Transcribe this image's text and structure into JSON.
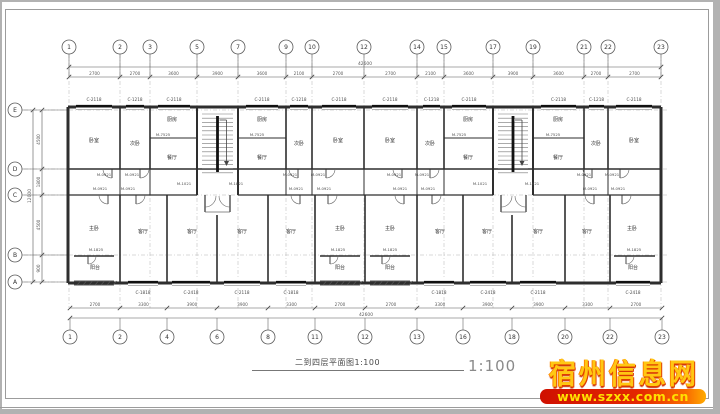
{
  "title_block": {
    "title": "二到四层平面图1:100",
    "scale": "1:100"
  },
  "watermark": {
    "site_name": "宿州信息网",
    "url": "www.szxx.com.cn",
    "banner_color": "#e42800",
    "url_color": "#ffe000",
    "name_color": "#ffc713"
  },
  "colors": {
    "wall": "#2e2e2e",
    "thin": "#6e6e6e",
    "grid": "#b5b5b5",
    "dim": "#5a5a5a",
    "bubble": "#5a5a5a",
    "room_text": "#333333",
    "tag_text": "#4a4a4a"
  },
  "grids": {
    "top": {
      "labels": [
        "1",
        "2",
        "3",
        "5",
        "7",
        "9",
        "10",
        "12",
        "14",
        "15",
        "17",
        "19",
        "21",
        "22",
        "23"
      ],
      "x": [
        69,
        120,
        150,
        197,
        238,
        286,
        312,
        364,
        417,
        444,
        493,
        533,
        584,
        608,
        661
      ],
      "bubble_y": 47
    },
    "bottom": {
      "labels": [
        "1",
        "2",
        "4",
        "6",
        "8",
        "11",
        "12",
        "13",
        "16",
        "18",
        "20",
        "22",
        "23"
      ],
      "x": [
        70,
        120,
        167,
        217,
        268,
        315,
        365,
        417,
        463,
        512,
        565,
        610,
        662
      ],
      "bubble_y": 337
    },
    "left": {
      "labels": [
        "E",
        "D",
        "C",
        "B",
        "A"
      ],
      "y": [
        110,
        169,
        195,
        255,
        282
      ],
      "bubble_x": 15
    }
  },
  "dimensions": {
    "top_values": [
      "2700",
      "2700",
      "3600",
      "3900",
      "3600",
      "2100",
      "2700",
      "2700",
      "2100",
      "3600",
      "3900",
      "3600",
      "2700",
      "2700"
    ],
    "top_total": "42600",
    "bottom_values": [
      "2700",
      "3300",
      "3900",
      "3900",
      "3300",
      "2700",
      "2700",
      "3300",
      "3900",
      "3900",
      "3300",
      "2700"
    ],
    "bottom_total": "42600",
    "left_values": [
      "4500",
      "1800",
      "4500",
      "900"
    ],
    "left_total": "12000"
  },
  "plan": {
    "outline": {
      "x1": 68,
      "y1": 107,
      "x2": 661,
      "y2": 283
    },
    "walls": [
      [
        68,
        107,
        661,
        107,
        3
      ],
      [
        68,
        283,
        661,
        283,
        3
      ],
      [
        68,
        107,
        68,
        283,
        3
      ],
      [
        661,
        107,
        661,
        283,
        3
      ],
      [
        68,
        169,
        661,
        169,
        1.5
      ],
      [
        68,
        195,
        197,
        195,
        1.3
      ],
      [
        238,
        195,
        493,
        195,
        1.3
      ],
      [
        533,
        195,
        661,
        195,
        1.3
      ],
      [
        74,
        256,
        114,
        256,
        1.6
      ],
      [
        320,
        256,
        360,
        256,
        1.6
      ],
      [
        370,
        256,
        410,
        256,
        1.6
      ],
      [
        614,
        256,
        655,
        256,
        1.6
      ],
      [
        120,
        107,
        120,
        169,
        1.6
      ],
      [
        150,
        107,
        150,
        169,
        1.6
      ],
      [
        197,
        107,
        197,
        195,
        2
      ],
      [
        238,
        107,
        238,
        195,
        2
      ],
      [
        286,
        107,
        286,
        169,
        1.6
      ],
      [
        312,
        107,
        312,
        169,
        1.6
      ],
      [
        364,
        107,
        364,
        169,
        1.6
      ],
      [
        417,
        107,
        417,
        169,
        1.6
      ],
      [
        444,
        107,
        444,
        169,
        1.6
      ],
      [
        493,
        107,
        493,
        195,
        2
      ],
      [
        533,
        107,
        533,
        195,
        2
      ],
      [
        584,
        107,
        584,
        169,
        1.6
      ],
      [
        608,
        107,
        608,
        169,
        1.6
      ],
      [
        120,
        169,
        120,
        195,
        1
      ],
      [
        150,
        169,
        150,
        195,
        1
      ],
      [
        286,
        169,
        286,
        195,
        1
      ],
      [
        312,
        169,
        312,
        195,
        1
      ],
      [
        364,
        169,
        364,
        195,
        1
      ],
      [
        417,
        169,
        417,
        195,
        1
      ],
      [
        444,
        169,
        444,
        195,
        1
      ],
      [
        584,
        169,
        584,
        195,
        1
      ],
      [
        608,
        169,
        608,
        195,
        1
      ],
      [
        120,
        195,
        120,
        283,
        1.6
      ],
      [
        167,
        195,
        167,
        283,
        1.6
      ],
      [
        217,
        215,
        217,
        283,
        1.6
      ],
      [
        268,
        195,
        268,
        283,
        1.6
      ],
      [
        315,
        195,
        315,
        283,
        1.6
      ],
      [
        365,
        195,
        365,
        283,
        1.6
      ],
      [
        417,
        195,
        417,
        283,
        1.6
      ],
      [
        463,
        195,
        463,
        283,
        1.6
      ],
      [
        512,
        215,
        512,
        283,
        1.6
      ],
      [
        565,
        195,
        565,
        283,
        1.6
      ],
      [
        610,
        195,
        610,
        283,
        1.6
      ],
      [
        150,
        138,
        197,
        138,
        0.9
      ],
      [
        238,
        138,
        286,
        138,
        0.9
      ],
      [
        444,
        138,
        493,
        138,
        0.9
      ],
      [
        533,
        138,
        584,
        138,
        0.9
      ]
    ],
    "stairs": [
      {
        "x1": 197,
        "x2": 238,
        "y1": 110,
        "y2": 176
      },
      {
        "x1": 493,
        "x2": 533,
        "y1": 110,
        "y2": 176
      }
    ],
    "entries": [
      {
        "x1": 205,
        "x2": 230,
        "y": 195,
        "depth": 17
      },
      {
        "x1": 501,
        "x2": 526,
        "y": 195,
        "depth": 17
      }
    ],
    "windows_top": [
      {
        "label": "C-2118",
        "x1": 76,
        "x2": 112
      },
      {
        "label": "C-1218",
        "x1": 126,
        "x2": 144
      },
      {
        "label": "C-2118",
        "x1": 158,
        "x2": 190
      },
      {
        "label": "C-2118",
        "x1": 246,
        "x2": 278
      },
      {
        "label": "C-1218",
        "x1": 290,
        "x2": 308
      },
      {
        "label": "C-2118",
        "x1": 322,
        "x2": 356
      },
      {
        "label": "C-2118",
        "x1": 372,
        "x2": 408
      },
      {
        "label": "C-1218",
        "x1": 423,
        "x2": 440
      },
      {
        "label": "C-2118",
        "x1": 452,
        "x2": 486
      },
      {
        "label": "C-2118",
        "x1": 541,
        "x2": 576
      },
      {
        "label": "C-1218",
        "x1": 589,
        "x2": 604
      },
      {
        "label": "C-2118",
        "x1": 616,
        "x2": 652
      }
    ],
    "windows_bottom": [
      {
        "label": "C-1818",
        "x1": 128,
        "x2": 158
      },
      {
        "label": "C-2418",
        "x1": 172,
        "x2": 210
      },
      {
        "label": "C-2118",
        "x1": 224,
        "x2": 260
      },
      {
        "label": "C-1818",
        "x1": 276,
        "x2": 306
      },
      {
        "label": "C-1818",
        "x1": 424,
        "x2": 454
      },
      {
        "label": "C-2418",
        "x1": 470,
        "x2": 506
      },
      {
        "label": "C-2118",
        "x1": 520,
        "x2": 556
      },
      {
        "label": "C-2418",
        "x1": 616,
        "x2": 650
      }
    ],
    "balconies": [
      {
        "x1": 74,
        "x2": 114
      },
      {
        "x1": 320,
        "x2": 360
      },
      {
        "x1": 370,
        "x2": 410
      }
    ],
    "doors": [
      {
        "x": 112,
        "y": 169,
        "r": 9,
        "o": "dl"
      },
      {
        "x": 140,
        "y": 169,
        "r": 9,
        "o": "dr"
      },
      {
        "x": 298,
        "y": 169,
        "r": 9,
        "o": "dl"
      },
      {
        "x": 326,
        "y": 169,
        "r": 9,
        "o": "dr"
      },
      {
        "x": 402,
        "y": 169,
        "r": 9,
        "o": "dl"
      },
      {
        "x": 430,
        "y": 169,
        "r": 9,
        "o": "dr"
      },
      {
        "x": 592,
        "y": 169,
        "r": 9,
        "o": "dl"
      },
      {
        "x": 620,
        "y": 169,
        "r": 9,
        "o": "dr"
      },
      {
        "x": 108,
        "y": 195,
        "r": 9,
        "o": "dl"
      },
      {
        "x": 136,
        "y": 195,
        "r": 9,
        "o": "dr"
      },
      {
        "x": 300,
        "y": 195,
        "r": 9,
        "o": "dl"
      },
      {
        "x": 328,
        "y": 195,
        "r": 9,
        "o": "dr"
      },
      {
        "x": 404,
        "y": 195,
        "r": 9,
        "o": "dl"
      },
      {
        "x": 432,
        "y": 195,
        "r": 9,
        "o": "dr"
      },
      {
        "x": 594,
        "y": 195,
        "r": 9,
        "o": "dl"
      },
      {
        "x": 622,
        "y": 195,
        "r": 9,
        "o": "dr"
      },
      {
        "x": 205,
        "y": 196,
        "r": 11,
        "o": "dr"
      },
      {
        "x": 230,
        "y": 196,
        "r": 11,
        "o": "dl"
      },
      {
        "x": 501,
        "y": 196,
        "r": 11,
        "o": "dr"
      },
      {
        "x": 526,
        "y": 196,
        "r": 11,
        "o": "dl"
      },
      {
        "x": 88,
        "y": 256,
        "r": 8,
        "o": "dr"
      },
      {
        "x": 330,
        "y": 256,
        "r": 8,
        "o": "dr"
      },
      {
        "x": 382,
        "y": 256,
        "r": 8,
        "o": "dr"
      },
      {
        "x": 626,
        "y": 256,
        "r": 8,
        "o": "dr"
      }
    ],
    "rooms": [
      {
        "label": "卧室",
        "x": 94,
        "y": 142
      },
      {
        "label": "卧室",
        "x": 338,
        "y": 142
      },
      {
        "label": "卧室",
        "x": 390,
        "y": 142
      },
      {
        "label": "卧室",
        "x": 634,
        "y": 142
      },
      {
        "label": "次卧",
        "x": 135,
        "y": 145
      },
      {
        "label": "次卧",
        "x": 299,
        "y": 145
      },
      {
        "label": "次卧",
        "x": 430,
        "y": 145
      },
      {
        "label": "次卧",
        "x": 596,
        "y": 145
      },
      {
        "label": "厨房",
        "x": 172,
        "y": 121
      },
      {
        "label": "厨房",
        "x": 262,
        "y": 121
      },
      {
        "label": "厨房",
        "x": 468,
        "y": 121
      },
      {
        "label": "厨房",
        "x": 558,
        "y": 121
      },
      {
        "label": "餐厅",
        "x": 172,
        "y": 159
      },
      {
        "label": "餐厅",
        "x": 262,
        "y": 159
      },
      {
        "label": "餐厅",
        "x": 468,
        "y": 159
      },
      {
        "label": "餐厅",
        "x": 558,
        "y": 159
      },
      {
        "label": "客厅",
        "x": 143,
        "y": 233
      },
      {
        "label": "客厅",
        "x": 192,
        "y": 233
      },
      {
        "label": "客厅",
        "x": 242,
        "y": 233
      },
      {
        "label": "客厅",
        "x": 291,
        "y": 233
      },
      {
        "label": "客厅",
        "x": 440,
        "y": 233
      },
      {
        "label": "客厅",
        "x": 487,
        "y": 233
      },
      {
        "label": "客厅",
        "x": 538,
        "y": 233
      },
      {
        "label": "客厅",
        "x": 587,
        "y": 233
      },
      {
        "label": "主卧",
        "x": 94,
        "y": 230
      },
      {
        "label": "主卧",
        "x": 340,
        "y": 230
      },
      {
        "label": "主卧",
        "x": 390,
        "y": 230
      },
      {
        "label": "主卧",
        "x": 632,
        "y": 230
      },
      {
        "label": "阳台",
        "x": 95,
        "y": 269
      },
      {
        "label": "阳台",
        "x": 340,
        "y": 269
      },
      {
        "label": "阳台",
        "x": 390,
        "y": 269
      },
      {
        "label": "阳台",
        "x": 633,
        "y": 269
      }
    ],
    "door_tags": [
      {
        "text": "M-0921",
        "x": 104,
        "y": 176
      },
      {
        "text": "M-0921",
        "x": 132,
        "y": 176
      },
      {
        "text": "M-0921",
        "x": 290,
        "y": 176
      },
      {
        "text": "M-0921",
        "x": 318,
        "y": 176
      },
      {
        "text": "M-0921",
        "x": 394,
        "y": 176
      },
      {
        "text": "M-0921",
        "x": 422,
        "y": 176
      },
      {
        "text": "M-0921",
        "x": 584,
        "y": 176
      },
      {
        "text": "M-0921",
        "x": 612,
        "y": 176
      },
      {
        "text": "M-0921",
        "x": 100,
        "y": 190
      },
      {
        "text": "M-0921",
        "x": 128,
        "y": 190
      },
      {
        "text": "M-0921",
        "x": 296,
        "y": 190
      },
      {
        "text": "M-0921",
        "x": 324,
        "y": 190
      },
      {
        "text": "M-0921",
        "x": 400,
        "y": 190
      },
      {
        "text": "M-0921",
        "x": 428,
        "y": 190
      },
      {
        "text": "M-0921",
        "x": 590,
        "y": 190
      },
      {
        "text": "M-0921",
        "x": 618,
        "y": 190
      },
      {
        "text": "M-7525",
        "x": 163,
        "y": 136
      },
      {
        "text": "M-7525",
        "x": 257,
        "y": 136
      },
      {
        "text": "M-7525",
        "x": 459,
        "y": 136
      },
      {
        "text": "M-7525",
        "x": 553,
        "y": 136
      },
      {
        "text": "M-1021",
        "x": 184,
        "y": 185
      },
      {
        "text": "M-1821",
        "x": 236,
        "y": 185
      },
      {
        "text": "M-1021",
        "x": 480,
        "y": 185
      },
      {
        "text": "M-1821",
        "x": 532,
        "y": 185
      },
      {
        "text": "M-1825",
        "x": 96,
        "y": 251
      },
      {
        "text": "M-1825",
        "x": 338,
        "y": 251
      },
      {
        "text": "M-1825",
        "x": 390,
        "y": 251
      },
      {
        "text": "M-1825",
        "x": 634,
        "y": 251
      }
    ]
  }
}
